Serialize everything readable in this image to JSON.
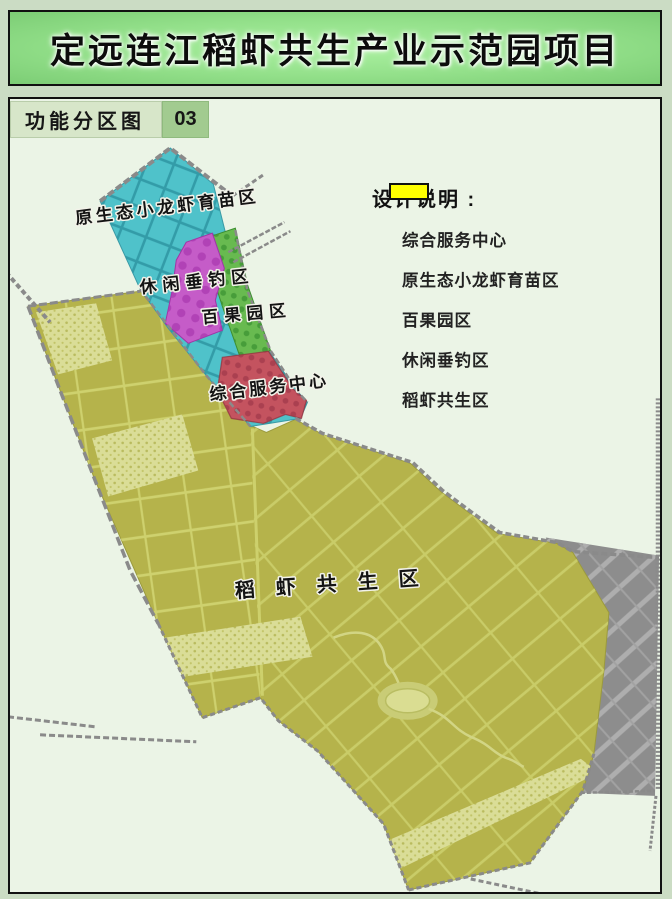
{
  "title": {
    "text": "定远连江稻虾共生产业示范园项目"
  },
  "subtitle": {
    "label": "功能分区图",
    "number": "03"
  },
  "legend": {
    "title": "设计说明 :",
    "items": [
      {
        "label": "综合服务中心",
        "color": "#e8112e"
      },
      {
        "label": "原生态小龙虾育苗区",
        "color": "#00dee0"
      },
      {
        "label": "百果园区",
        "color": "#3ed400"
      },
      {
        "label": "休闲垂钓区",
        "color": "#e400e4"
      },
      {
        "label": "稻虾共生区",
        "color": "#ffff00"
      }
    ]
  },
  "map": {
    "labels": {
      "crayfish": "原生态小龙虾育苗区",
      "fishing": "休闲垂钓区",
      "orchard": "百果园区",
      "service": "综合服务中心",
      "rice_shrimp": "稻 虾 共 生 区"
    },
    "colors": {
      "bg": "#ebf4e6",
      "cyan": "#4fc2ca",
      "magenta": "#c55cc8",
      "green": "#68ba50",
      "red": "#c4535f",
      "yellow": "#b5b34b",
      "yellow_light": "#dadd97",
      "gray": "#8d8d8d",
      "road": "#8a8a8a"
    }
  }
}
